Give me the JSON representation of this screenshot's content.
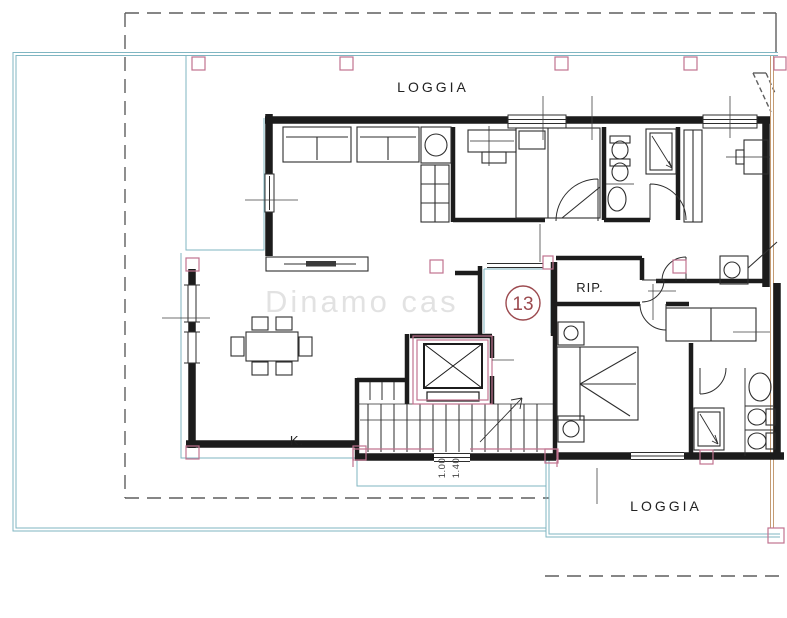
{
  "labels": {
    "loggia_top": "LOGGIA",
    "loggia_bottom": "LOGGIA",
    "storage_room": "RIP.",
    "kitchen": "K.",
    "apartment_number": "13",
    "entrance_dim_1": "1.00",
    "entrance_dim_2": "1.40",
    "watermark": "Dinamo cas"
  },
  "colors": {
    "paper": "#ffffff",
    "walls": "#1c1c1c",
    "furniture": "#2e2e2e",
    "terrace_outline": "#7fb6c2",
    "structure_accent": "#c0738f",
    "boundary_dashed": "#5f5f5f",
    "property_line": "#c49b73",
    "apartment_number": "#9c4a4f",
    "dimension_text": "#444444",
    "watermark": "#9a9a9a"
  }
}
